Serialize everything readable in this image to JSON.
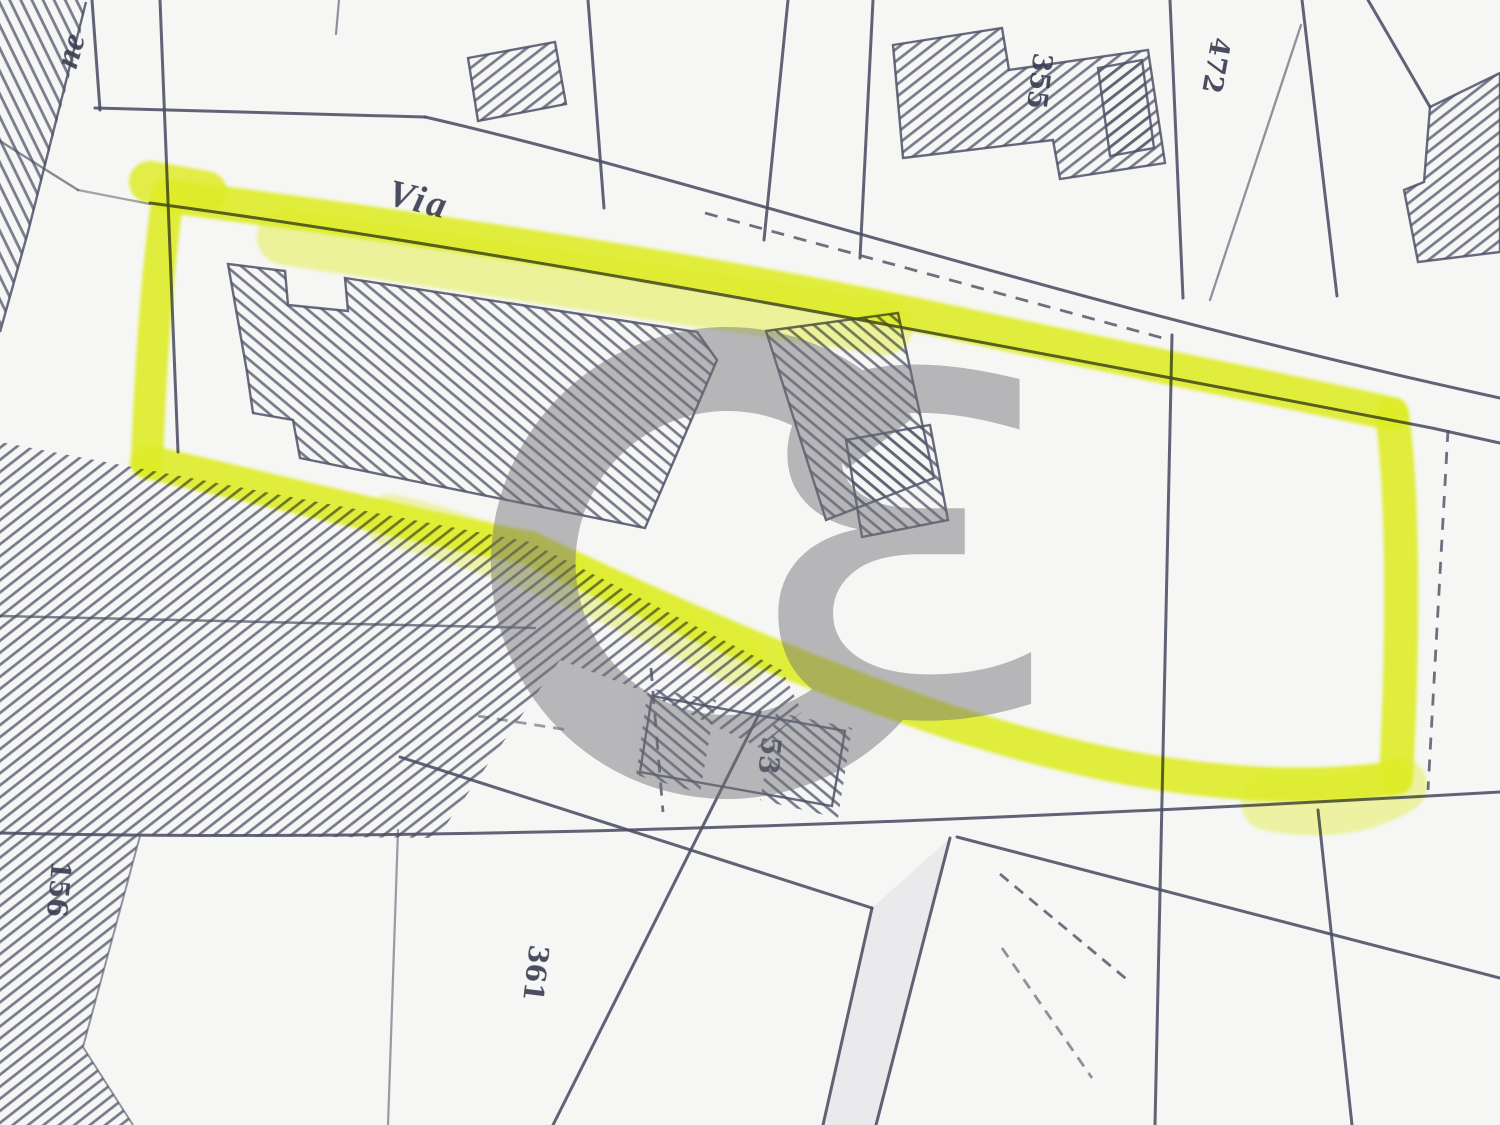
{
  "map": {
    "type_note": "scanned cadastral map extract with highlighted parcel",
    "street_label": "Via",
    "street_fragment": "ne",
    "parcel_numbers": {
      "top_building": "355",
      "top_right_strip": "472",
      "left_strip": "156",
      "center_parcel": "53",
      "bottom_parcel": "361"
    },
    "watermark": {
      "letter_primary": "C",
      "letter_secondary": "ɛ"
    },
    "colors": {
      "highlighter": "#e7f52a",
      "highlighter_light": "#ecf754",
      "map_line": "#4b4f63",
      "hatch_line": "#585c70",
      "paper": "#f6f6f4",
      "watermark_gray": "#707076"
    }
  }
}
